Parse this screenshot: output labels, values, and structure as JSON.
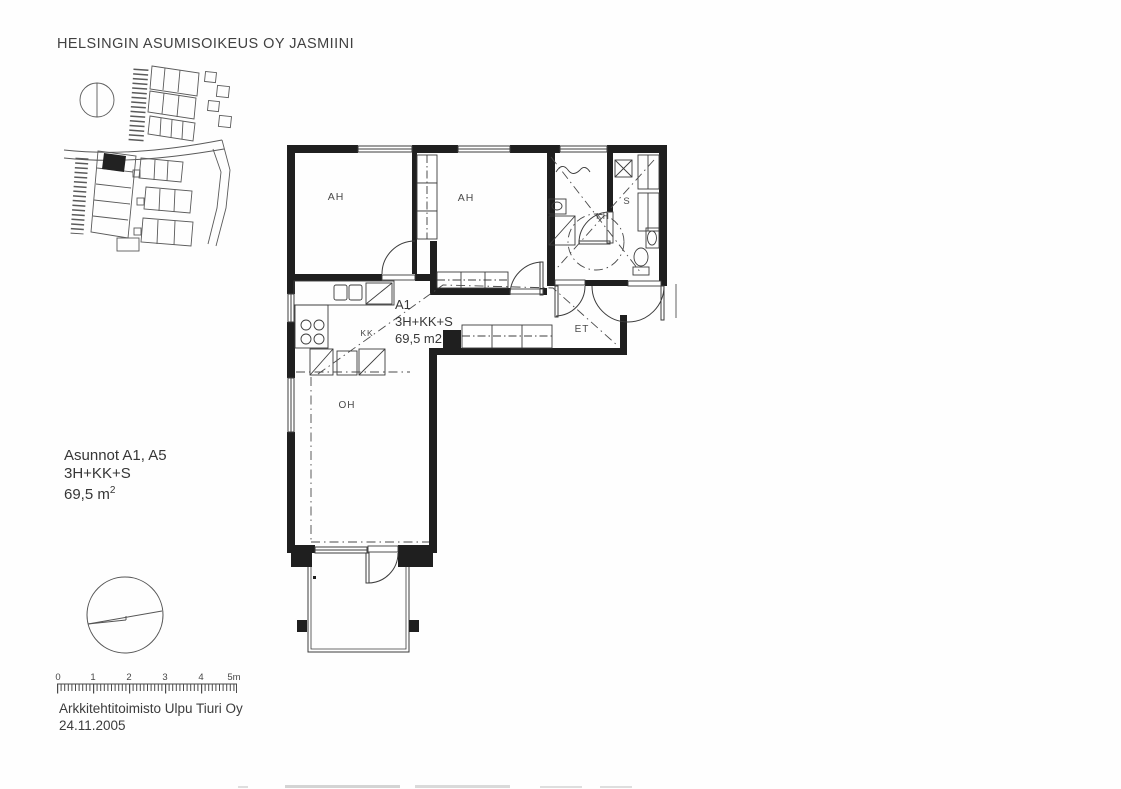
{
  "document": {
    "title": "HELSINGIN ASUMISOIKEUS OY JASMIINI",
    "info_block": {
      "apartments_line": "Asunnot A1, A5",
      "type_line": "3H+KK+S",
      "area_value": "69,5 m",
      "area_superscript": "2"
    },
    "footer": {
      "architect": "Arkkitehtitoimisto Ulpu Tiuri Oy",
      "date": "24.11.2005"
    }
  },
  "floor_plan": {
    "apartment_id": "A1",
    "apartment_type": "3H+KK+S",
    "apartment_area": "69,5 m2",
    "room_labels": {
      "bedroom_1": "AH",
      "bedroom_2": "AH",
      "bathroom": "KH",
      "sauna": "S",
      "kitchenette": "KK",
      "entry_hall": "ET",
      "living_room": "OH"
    }
  },
  "scale_bar": {
    "tick_labels": [
      "0",
      "1",
      "2",
      "3",
      "4",
      "5m"
    ]
  },
  "colors": {
    "wall": "#1f1f1f",
    "line": "#3c3c3c",
    "site_line": "#5a5a5a",
    "background": "#fefefe"
  }
}
